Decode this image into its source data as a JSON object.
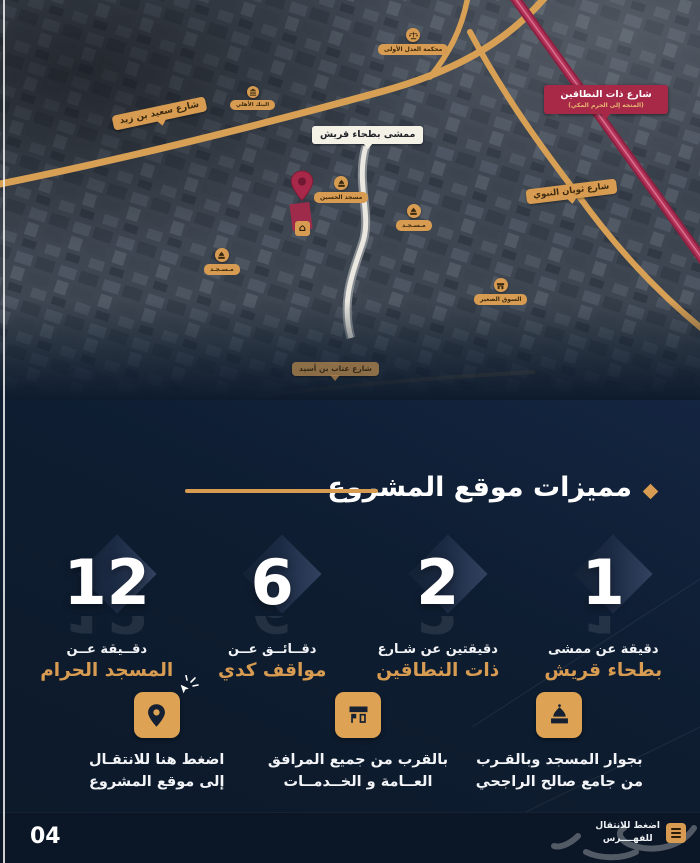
{
  "colors": {
    "gold": "#d79c52",
    "navy": "#0d1b2d",
    "crimson": "#a72847",
    "label_red": "#a72847",
    "white": "#ffffff"
  },
  "map": {
    "walkway_label": "ممشى بطحاء قريش",
    "red_road_label": {
      "title": "شارع ذات النطاقين",
      "subtitle": "(المتجه إلى الحرم المكي)"
    },
    "streets": [
      {
        "label": "شارع سعيد بن زيد"
      },
      {
        "label": "شارع ثوبان النبوي"
      },
      {
        "label": "شارع عتاب بن أسيد"
      }
    ],
    "pois": [
      {
        "name": "court",
        "label": "محكمة العدل الأولى"
      },
      {
        "name": "bank",
        "label": "البنك الأهلي"
      },
      {
        "name": "mosque",
        "label": "مسجد الحسين"
      },
      {
        "name": "mosque",
        "label": "مـسـجـد"
      },
      {
        "name": "mosque",
        "label": "مـسـجـد"
      },
      {
        "name": "market",
        "label": "السوق الصغير"
      }
    ]
  },
  "section_title": "مميزات موقع المشروع",
  "stats": [
    {
      "value": "1",
      "line1": "دقيقة عن ممشى",
      "line2": "بطحاء قريش"
    },
    {
      "value": "2",
      "line1": "دقيقتين عن شـارع",
      "line2": "ذات النطاقين"
    },
    {
      "value": "6",
      "line1": "دقــائــق عــن",
      "line2": "مواقف كدي"
    },
    {
      "value": "12",
      "line1": "دقــيقة عــن",
      "line2": "المسجد الحرام"
    }
  ],
  "features": [
    {
      "name": "mosque",
      "line1": "بجوار المسجد وبالقـرب",
      "line2": "من جامع صالح الراجحي"
    },
    {
      "name": "facilities",
      "line1": "بالقرب من جميع المرافق",
      "line2": "العــامة و الخــدمــات"
    },
    {
      "name": "location",
      "line1": "اضغط هنا للانتقـال",
      "line2": "إلى موقع المشروع"
    }
  ],
  "footer": {
    "page_number": "04",
    "index_line1": "اضغط للانتقال",
    "index_line2": "للفهــــرس"
  }
}
